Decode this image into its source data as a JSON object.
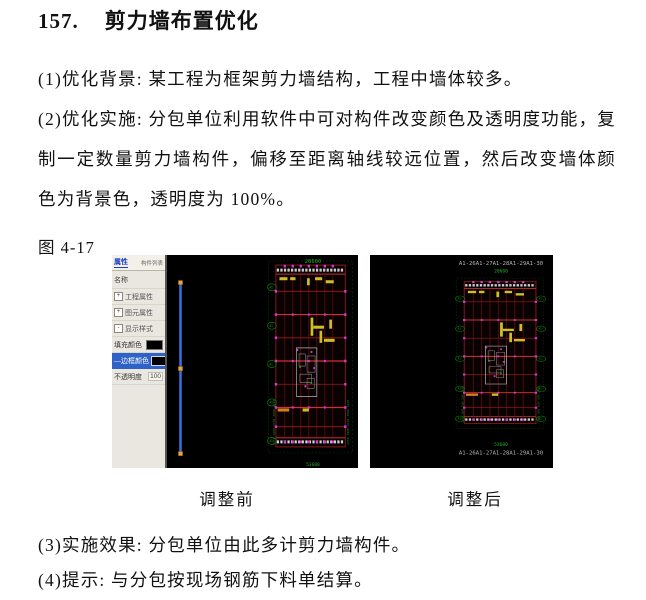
{
  "document": {
    "heading": {
      "number": "157.",
      "title": "剪力墙布置优化"
    },
    "paragraphs": {
      "p1": "(1)优化背景: 某工程为框架剪力墙结构，工程中墙体较多。",
      "p2": "(2)优化实施: 分包单位利用软件中可对构件改变颜色及透明度功能，复制一定数量剪力墙构件，偏移至距离轴线较远位置，然后改变墙体颜色为背景色，透明度为 100%。",
      "p3": "(3)实施效果: 分包单位由此多计剪力墙构件。",
      "p4": "(4)提示: 与分包按现场钢筋下料单结算。"
    },
    "figure": {
      "label": "图 4-17",
      "caption_before": "调整前",
      "caption_after": "调整后"
    }
  },
  "props_panel": {
    "tab_active": "属性",
    "tab_inactive": "构件列表",
    "name_row": "名称",
    "groups": [
      {
        "expander": "+",
        "label": "工程属性"
      },
      {
        "expander": "+",
        "label": "图元属性"
      },
      {
        "expander": "-",
        "label": "显示样式"
      }
    ],
    "fill_color_label": "填充颜色",
    "border_color_label": "边框颜色",
    "opacity_label": "不透明度",
    "opacity_value": "100",
    "swatch_color": "#000000"
  },
  "cad": {
    "axis_row_top": "A1-26A1-27A1-28A1-29A1-30",
    "axis_row_bottom": "A1-26A1-27A1-28A1-29A1-30",
    "dim_top_left": "20600",
    "dim_top_right": "20600",
    "dim_bottom_left": "53600",
    "dim_bottom_right": "53600",
    "side_dims": "2450 3800 2450 3800 2450",
    "axis_bubble": "A1-",
    "colors": {
      "canvas": "#000000",
      "grid_red": "#a11818",
      "bright_red": "#d23030",
      "axis_green": "#19b019",
      "node_magenta": "#dd33dd",
      "wall_yellow": "#cfc020",
      "wall_orange": "#d08020",
      "selected_blue": "#3f6bd6",
      "grip_orange": "#e8a33d",
      "panel_bg": "#e9e7df",
      "panel_selected": "#2f62c6"
    }
  }
}
